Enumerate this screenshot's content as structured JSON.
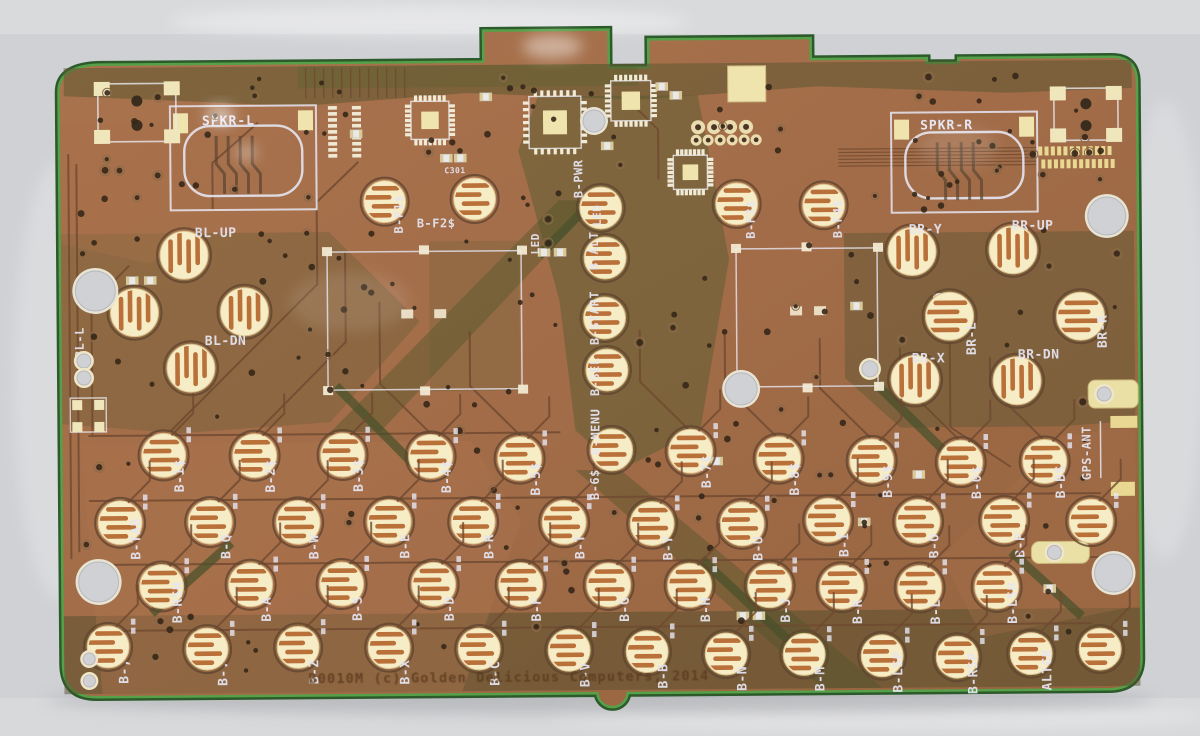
{
  "scene": {
    "description": "Photograph of a bare handheld-computer keyboard PCB (back side) lying on a grey surface",
    "width": 1200,
    "height": 736
  },
  "colors": {
    "background": "#cfd1d4",
    "board_copper": "#a26c48",
    "board_copper_dark": "#956440",
    "edge_green_bright": "#55a048",
    "edge_green_dark": "#2d5a2b",
    "soldermask_olive": "#565431",
    "pad_gold": "#f6ecc6",
    "pad_stripe_copper": "#b4652c",
    "silkscreen": "#e6e6f2",
    "trace_dark": "#6f4930",
    "copper_text": "#59381f"
  },
  "copper_text": {
    "text": "B0010M   (c) Golden  Delicious Computers,  2014",
    "x": 306,
    "y": 681
  },
  "speakers": [
    {
      "label": "SPKR-L",
      "x": 172,
      "y": 103,
      "w": 146,
      "h": 104,
      "tx": 204,
      "ty": 122
    },
    {
      "label": "SPKR-R",
      "x": 893,
      "y": 115,
      "w": 146,
      "h": 100,
      "tx": 922,
      "ty": 132
    }
  ],
  "extra_labels": [
    {
      "text": "BL-UP",
      "x": 196,
      "y": 234,
      "rot": 0,
      "size": 13
    },
    {
      "text": "BL-DN",
      "x": 205,
      "y": 342,
      "rot": 0,
      "size": 13
    },
    {
      "text": "BL-L",
      "x": 84,
      "y": 354,
      "rot": -90,
      "size": 12
    },
    {
      "text": "BR-Y",
      "x": 910,
      "y": 236,
      "rot": 0,
      "size": 13
    },
    {
      "text": "BR-UP",
      "x": 1013,
      "y": 233,
      "rot": 0,
      "size": 13
    },
    {
      "text": "BR-X",
      "x": 912,
      "y": 365,
      "rot": 0,
      "size": 13
    },
    {
      "text": "BR-DN",
      "x": 1018,
      "y": 362,
      "rot": 0,
      "size": 13
    },
    {
      "text": "BR-L",
      "x": 976,
      "y": 358,
      "rot": -90,
      "size": 13
    },
    {
      "text": "BR-R",
      "x": 1107,
      "y": 352,
      "rot": -90,
      "size": 13
    },
    {
      "text": "C301",
      "x": 446,
      "y": 172,
      "rot": 0,
      "size": 8
    },
    {
      "text": "LED",
      "x": 540,
      "y": 254,
      "rot": -90,
      "size": 11
    },
    {
      "text": "LED",
      "x": 602,
      "y": 226,
      "rot": -90,
      "size": 11
    },
    {
      "text": "B-ALT",
      "x": 599,
      "y": 270,
      "rot": -90,
      "size": 12
    },
    {
      "text": "B-START",
      "x": 599,
      "y": 345,
      "rot": -90,
      "size": 12
    },
    {
      "text": "B-SEL",
      "x": 599,
      "y": 396,
      "rot": -90,
      "size": 12
    },
    {
      "text": "B-MENU",
      "x": 599,
      "y": 455,
      "rot": -90,
      "size": 12
    },
    {
      "text": "GPS-ANT",
      "x": 1090,
      "y": 484,
      "rot": -90,
      "size": 12
    }
  ],
  "function_pads": [
    {
      "t": "B-F1$",
      "x": 386,
      "y": 200,
      "lx": 404,
      "ly": 232,
      "lr": -90
    },
    {
      "t": "B-F2$",
      "x": 476,
      "y": 198,
      "lx": 418,
      "ly": 226,
      "lr": 0
    },
    {
      "t": "B-PWR",
      "x": 602,
      "y": 208,
      "lx": 584,
      "ly": 198,
      "lr": -90
    },
    {
      "t": "B-F3$",
      "x": 738,
      "y": 205,
      "lx": 756,
      "ly": 240,
      "lr": -90
    },
    {
      "t": "B-F4$",
      "x": 825,
      "y": 207,
      "lx": 843,
      "ly": 240,
      "lr": -90
    },
    {
      "t": "B-6$",
      "x": 611,
      "y": 450,
      "lx": 598,
      "ly": 500,
      "lr": -90
    }
  ],
  "pad_rows": [
    {
      "name": "dpad-left",
      "stripes": "v",
      "r": 24,
      "pads": [
        [
          "",
          185,
          252
        ],
        [
          "",
          135,
          309
        ],
        [
          "",
          245,
          309
        ],
        [
          "",
          191,
          365
        ]
      ]
    },
    {
      "name": "action-right",
      "stripes": "v",
      "r": 24,
      "pads": [
        [
          "",
          913,
          254
        ],
        [
          "",
          1014,
          253
        ],
        [
          "",
          915,
          382
        ],
        [
          "",
          950,
          319,
          "h"
        ],
        [
          "",
          1017,
          384
        ],
        [
          "",
          1081,
          320,
          "h"
        ]
      ]
    },
    {
      "name": "center-column",
      "stripes": "h",
      "r": 21,
      "pads": [
        [
          "",
          606,
          258
        ],
        [
          "",
          605,
          318
        ],
        [
          "",
          607,
          370
        ]
      ]
    },
    {
      "name": "number-row",
      "stripes": "h",
      "r": 22,
      "pads": [
        [
          "B-1$",
          163,
          452
        ],
        [
          "B-2$",
          254,
          453
        ],
        [
          "B-3$",
          342,
          453
        ],
        [
          "B-4$",
          430,
          455
        ],
        [
          "B-5$",
          519,
          458
        ],
        [
          "B-7$",
          690,
          452
        ],
        [
          "B-8$",
          778,
          460
        ],
        [
          "B-9$",
          871,
          463
        ],
        [
          "B-0$",
          960,
          465
        ],
        [
          "B-BS",
          1044,
          465
        ]
      ]
    },
    {
      "name": "qwerty-row",
      "stripes": "h",
      "r": 22,
      "pads": [
        [
          "B-TAB",
          119,
          519
        ],
        [
          "B-Q",
          209,
          519
        ],
        [
          "B-W",
          297,
          520
        ],
        [
          "B-E",
          388,
          520
        ],
        [
          "B-R",
          472,
          521
        ],
        [
          "B-T",
          563,
          522
        ],
        [
          "B-Y",
          651,
          524
        ],
        [
          "B-U",
          741,
          525
        ],
        [
          "B-I",
          827,
          522
        ],
        [
          "B-O",
          917,
          524
        ],
        [
          "B-P",
          1003,
          524
        ],
        [
          "",
          1090,
          525
        ]
      ]
    },
    {
      "name": "home-row",
      "stripes": "h",
      "r": 22,
      "pads": [
        [
          "B-RSH",
          160,
          583
        ],
        [
          "B-A",
          249,
          582
        ],
        [
          "B-S",
          340,
          582
        ],
        [
          "B-D",
          432,
          583
        ],
        [
          "B-F",
          519,
          584
        ],
        [
          "B-G",
          607,
          585
        ],
        [
          "B-H",
          688,
          586
        ],
        [
          "B-J",
          768,
          587
        ],
        [
          "B-K",
          840,
          589
        ],
        [
          "B-L",
          918,
          590
        ],
        [
          "B-LSH",
          995,
          590
        ]
      ]
    },
    {
      "name": "bottom-row",
      "stripes": "h",
      "r": 21,
      "pads": [
        [
          "B-,",
          106,
          643
        ],
        [
          "B-.",
          205,
          646
        ],
        [
          "B-Z",
          296,
          645
        ],
        [
          "B-X",
          387,
          646
        ],
        [
          "B-C",
          477,
          648
        ],
        [
          "B-V",
          567,
          650
        ],
        [
          "B-B",
          645,
          652
        ],
        [
          "B-N",
          724,
          655
        ],
        [
          "B-M",
          802,
          656
        ],
        [
          "B-LSP",
          880,
          658
        ],
        [
          "B-RSP",
          955,
          660
        ],
        [
          "ALTGR",
          1029,
          657
        ],
        [
          "",
          1098,
          653
        ]
      ]
    }
  ],
  "holes": [
    [
      96,
      287,
      20,
      0
    ],
    [
      97,
      578,
      20,
      0
    ],
    [
      1108,
      220,
      19,
      0
    ],
    [
      1112,
      577,
      19,
      0
    ],
    [
      741,
      390,
      16,
      0
    ],
    [
      596,
      121,
      11,
      0
    ],
    [
      870,
      371,
      8,
      1
    ],
    [
      84,
      357,
      7,
      1
    ],
    [
      84,
      374,
      7,
      1
    ],
    [
      87,
      655,
      6,
      1
    ],
    [
      87,
      677,
      6,
      1
    ],
    [
      1104,
      398,
      7,
      1
    ],
    [
      1053,
      556,
      7,
      1
    ]
  ]
}
